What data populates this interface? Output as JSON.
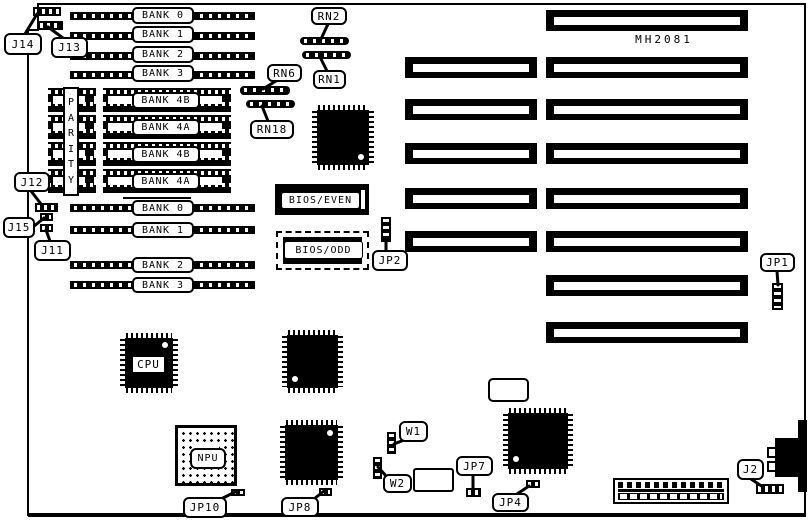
{
  "board": {
    "model": "MH2081"
  },
  "colors": {
    "ink": "#000000",
    "paper": "#ffffff"
  },
  "memory": {
    "simm_top": [
      "BANK 0",
      "BANK 1",
      "BANK 2",
      "BANK 3"
    ],
    "simm_bottom": [
      "BANK 0",
      "BANK 1",
      "BANK 2",
      "BANK 3"
    ],
    "dip_banks": [
      "BANK 4B",
      "BANK 4A",
      "BANK 4B",
      "BANK 4A"
    ],
    "parity_label": "PARITY"
  },
  "chips": {
    "cpu": "CPU",
    "npu": "NPU",
    "bios_even": "BIOS/EVEN",
    "bios_odd": "BIOS/ODD"
  },
  "resistor_networks": {
    "rn1": "RN1",
    "rn2": "RN2",
    "rn6": "RN6",
    "rn18": "RN18"
  },
  "connectors": {
    "j2": "J2",
    "j11": "J11",
    "j12": "J12",
    "j13": "J13",
    "j14": "J14",
    "j15": "J15"
  },
  "jumpers": {
    "jp1": "JP1",
    "jp2": "JP2",
    "jp4": "JP4",
    "jp7": "JP7",
    "jp8": "JP8",
    "jp10": "JP10",
    "w1": "W1",
    "w2": "W2"
  }
}
